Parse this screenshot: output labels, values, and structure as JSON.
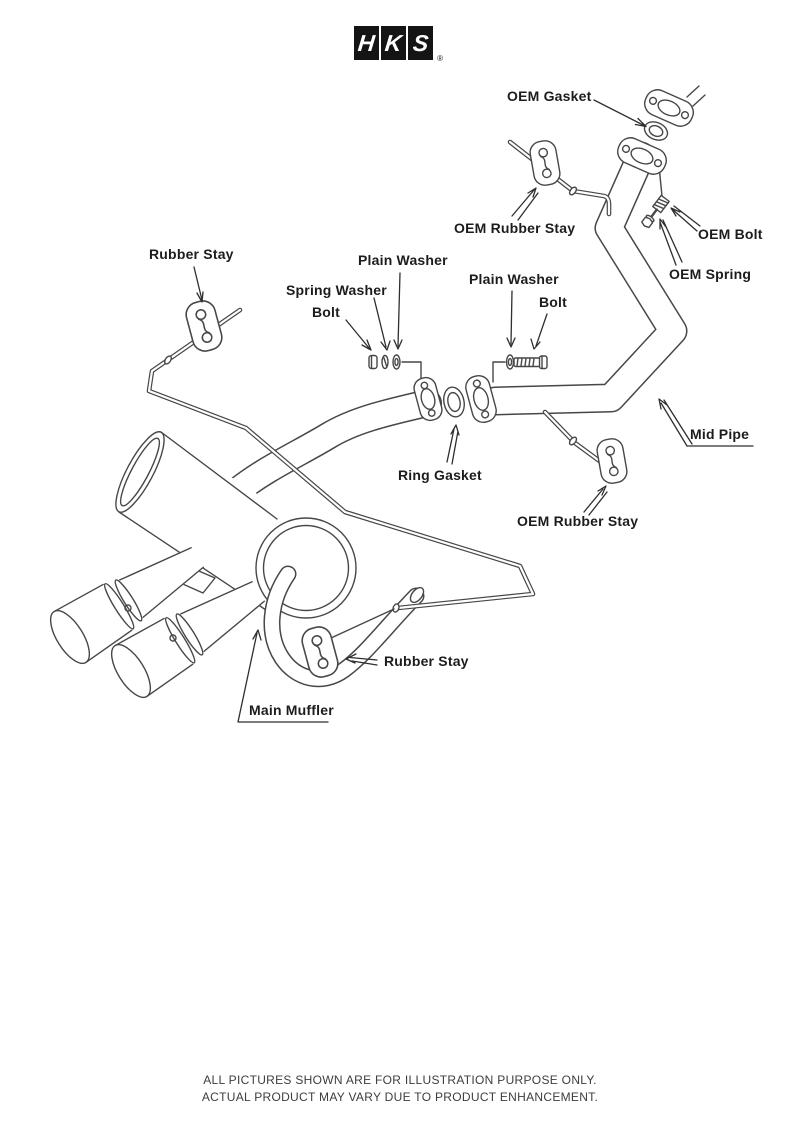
{
  "logo": {
    "letters": [
      "H",
      "K",
      "S"
    ],
    "registered": "®"
  },
  "labels": {
    "oem_gasket": "OEM Gasket",
    "oem_rubber_stay_top": "OEM Rubber Stay",
    "oem_bolt": "OEM Bolt",
    "oem_spring": "OEM Spring",
    "rubber_stay_left": "Rubber Stay",
    "plain_washer_left": "Plain Washer",
    "spring_washer": "Spring Washer",
    "bolt_left": "Bolt",
    "plain_washer_right": "Plain Washer",
    "bolt_right": "Bolt",
    "mid_pipe": "Mid Pipe",
    "ring_gasket": "Ring Gasket",
    "oem_rubber_stay_bottom": "OEM Rubber Stay",
    "rubber_stay_bottom": "Rubber Stay",
    "main_muffler": "Main Muffler"
  },
  "footer": {
    "line1": "ALL PICTURES SHOWN ARE FOR ILLUSTRATION PURPOSE ONLY.",
    "line2": "ACTUAL PRODUCT MAY VARY DUE TO PRODUCT ENHANCEMENT."
  },
  "colors": {
    "line": "#474747",
    "label": "#1c1c1c",
    "logo_bg": "#141414"
  }
}
